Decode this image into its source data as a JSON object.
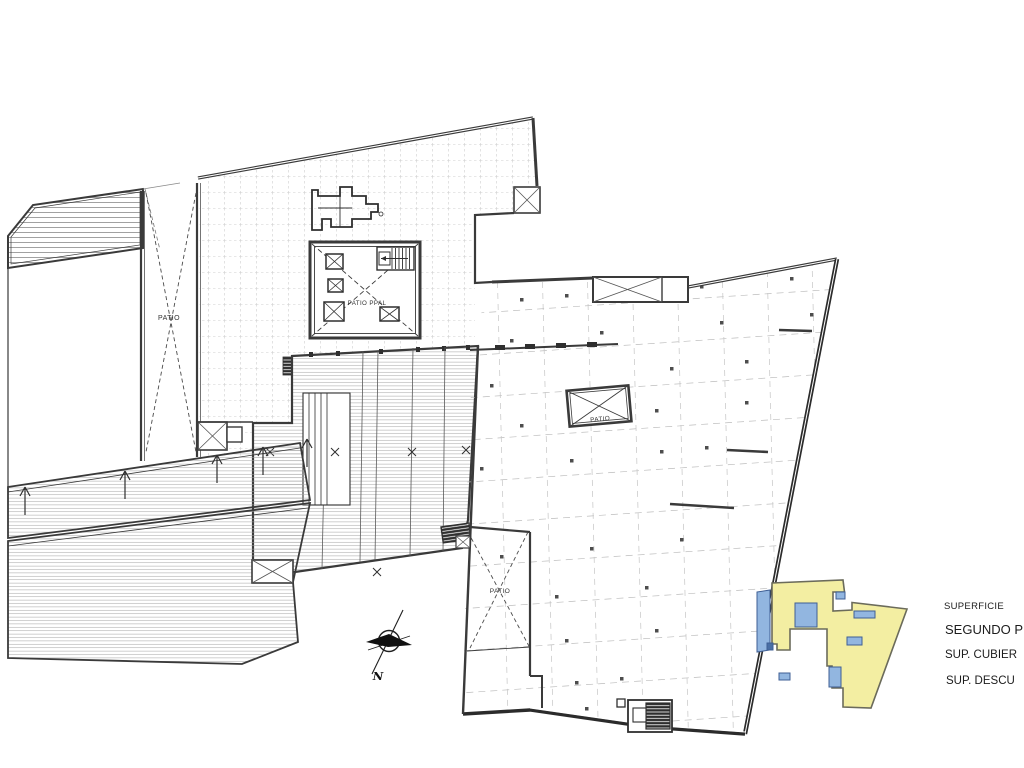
{
  "page": {
    "background": "#ffffff"
  },
  "plan": {
    "labels": {
      "patio_left": "PATIO",
      "patio_principal": "PATIO PPAL",
      "patio_center": "PATIO",
      "patio_lower": "PATIO"
    },
    "north_label": "N",
    "colors": {
      "line": "#3a3a3a",
      "hatch": "#9a9a9a",
      "grid_dash": "#c4c4c4"
    }
  },
  "key_plan": {
    "fill": "#f3eea2",
    "patch_fill": "#92b6e0",
    "patch_dark": "#4a6fa5",
    "outline": "#6b6b5b"
  },
  "legend": {
    "superficie": "SUPERFICIE",
    "floor": "SEGUNDO PI",
    "covered": "SUP. CUBIER",
    "uncovered": "SUP. DESCU"
  }
}
